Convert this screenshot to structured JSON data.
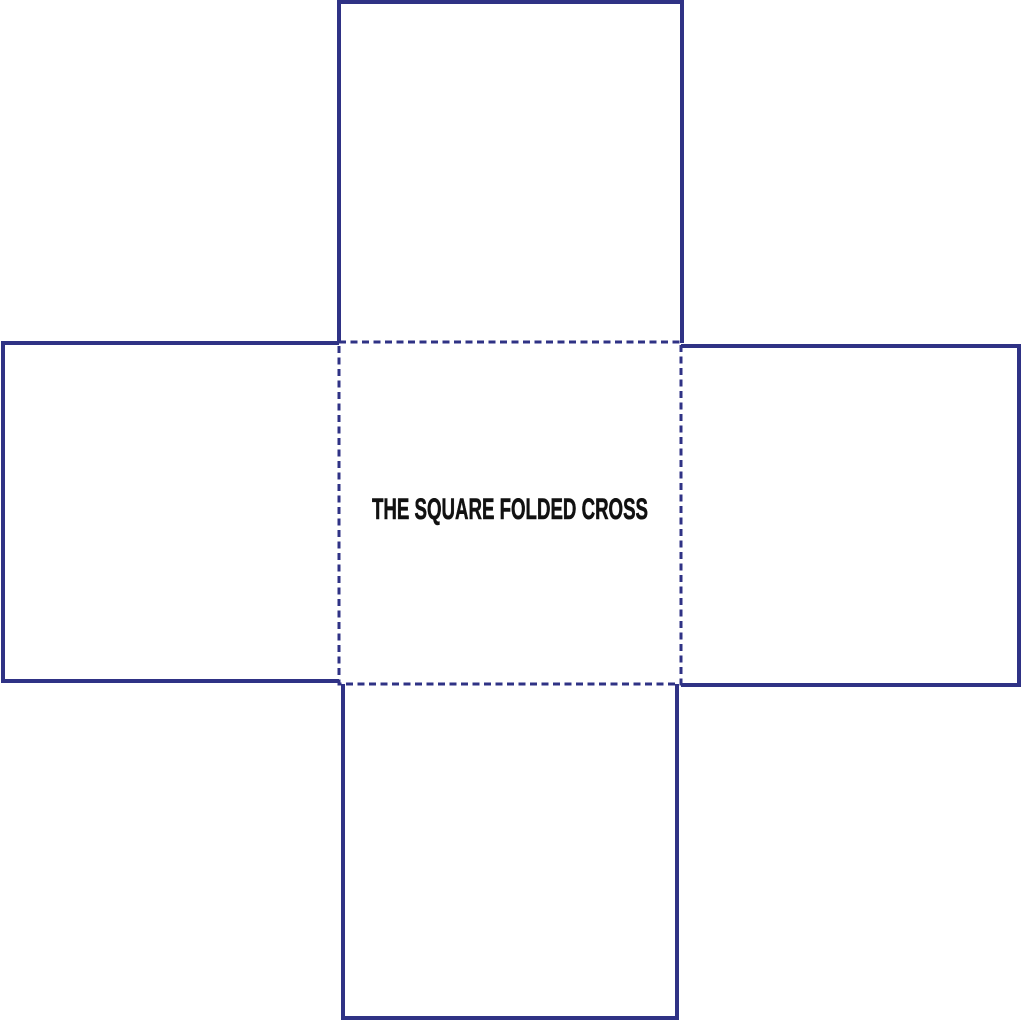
{
  "page": {
    "background_color": "#ffffff"
  },
  "diagram": {
    "label": "THE SQUARE FOLDED CROSS",
    "stroke_color": "#2f3285",
    "text_color": "#111111",
    "canvas": {
      "width": 1024,
      "height": 1024
    },
    "solid_stroke_width": 4,
    "fold_stroke_width": 3,
    "fold_dash": [
      7,
      4.5
    ],
    "center_square": {
      "name": "center-panel-fold-lines",
      "x": 339,
      "y": 342,
      "width": 342,
      "height": 342,
      "style": "dashed"
    },
    "flaps": [
      {
        "name": "flap-top",
        "x1": 339,
        "y1": 2,
        "x2": 682,
        "y2": 343,
        "open_side": "bottom"
      },
      {
        "name": "flap-left",
        "x1": 3,
        "y1": 343,
        "x2": 339,
        "y2": 681,
        "open_side": "right"
      },
      {
        "name": "flap-right",
        "x1": 681,
        "y1": 346,
        "x2": 1019,
        "y2": 685,
        "open_side": "left"
      },
      {
        "name": "flap-bottom",
        "x1": 343,
        "y1": 684,
        "x2": 677,
        "y2": 1018,
        "open_side": "top"
      }
    ],
    "label_layout": {
      "x": 510,
      "y": 519,
      "font_size": 30,
      "text_length": 276
    }
  }
}
